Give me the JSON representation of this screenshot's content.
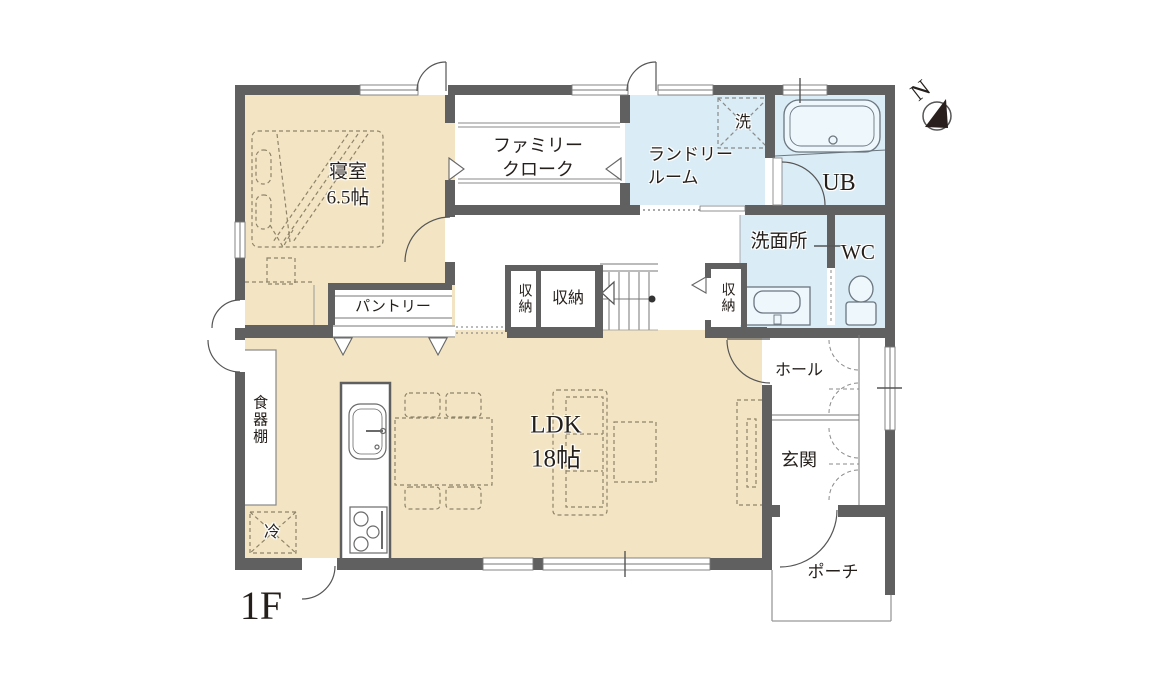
{
  "title": "1F間取り図",
  "floor_label": "1F",
  "compass": {
    "north_label": "N"
  },
  "colors": {
    "wall": "#606060",
    "room_beige": "#f3e5c4",
    "room_blue": "#daecf5",
    "thin_line": "#777777",
    "furniture_dash": "#8f8468"
  },
  "rooms": {
    "bedroom": {
      "label": "寝室\n6.5帖"
    },
    "family_cloak": {
      "label": "ファミリー\nクローク"
    },
    "laundry": {
      "label": "ランドリー\nルーム"
    },
    "washer": {
      "label": "洗"
    },
    "unit_bath": {
      "label": "UB"
    },
    "washroom": {
      "label": "洗面所"
    },
    "wc": {
      "label": "WC"
    },
    "pantry": {
      "label": "パントリー"
    },
    "storage1": {
      "label": "収納"
    },
    "storage2": {
      "label": "収納"
    },
    "storage3": {
      "label": "収納"
    },
    "ldk": {
      "label": "LDK\n18帖"
    },
    "cupboard": {
      "label": "食器棚"
    },
    "fridge": {
      "label": "冷"
    },
    "hall": {
      "label": "ホール"
    },
    "entrance": {
      "label": "玄関"
    },
    "porch": {
      "label": "ポーチ"
    }
  }
}
